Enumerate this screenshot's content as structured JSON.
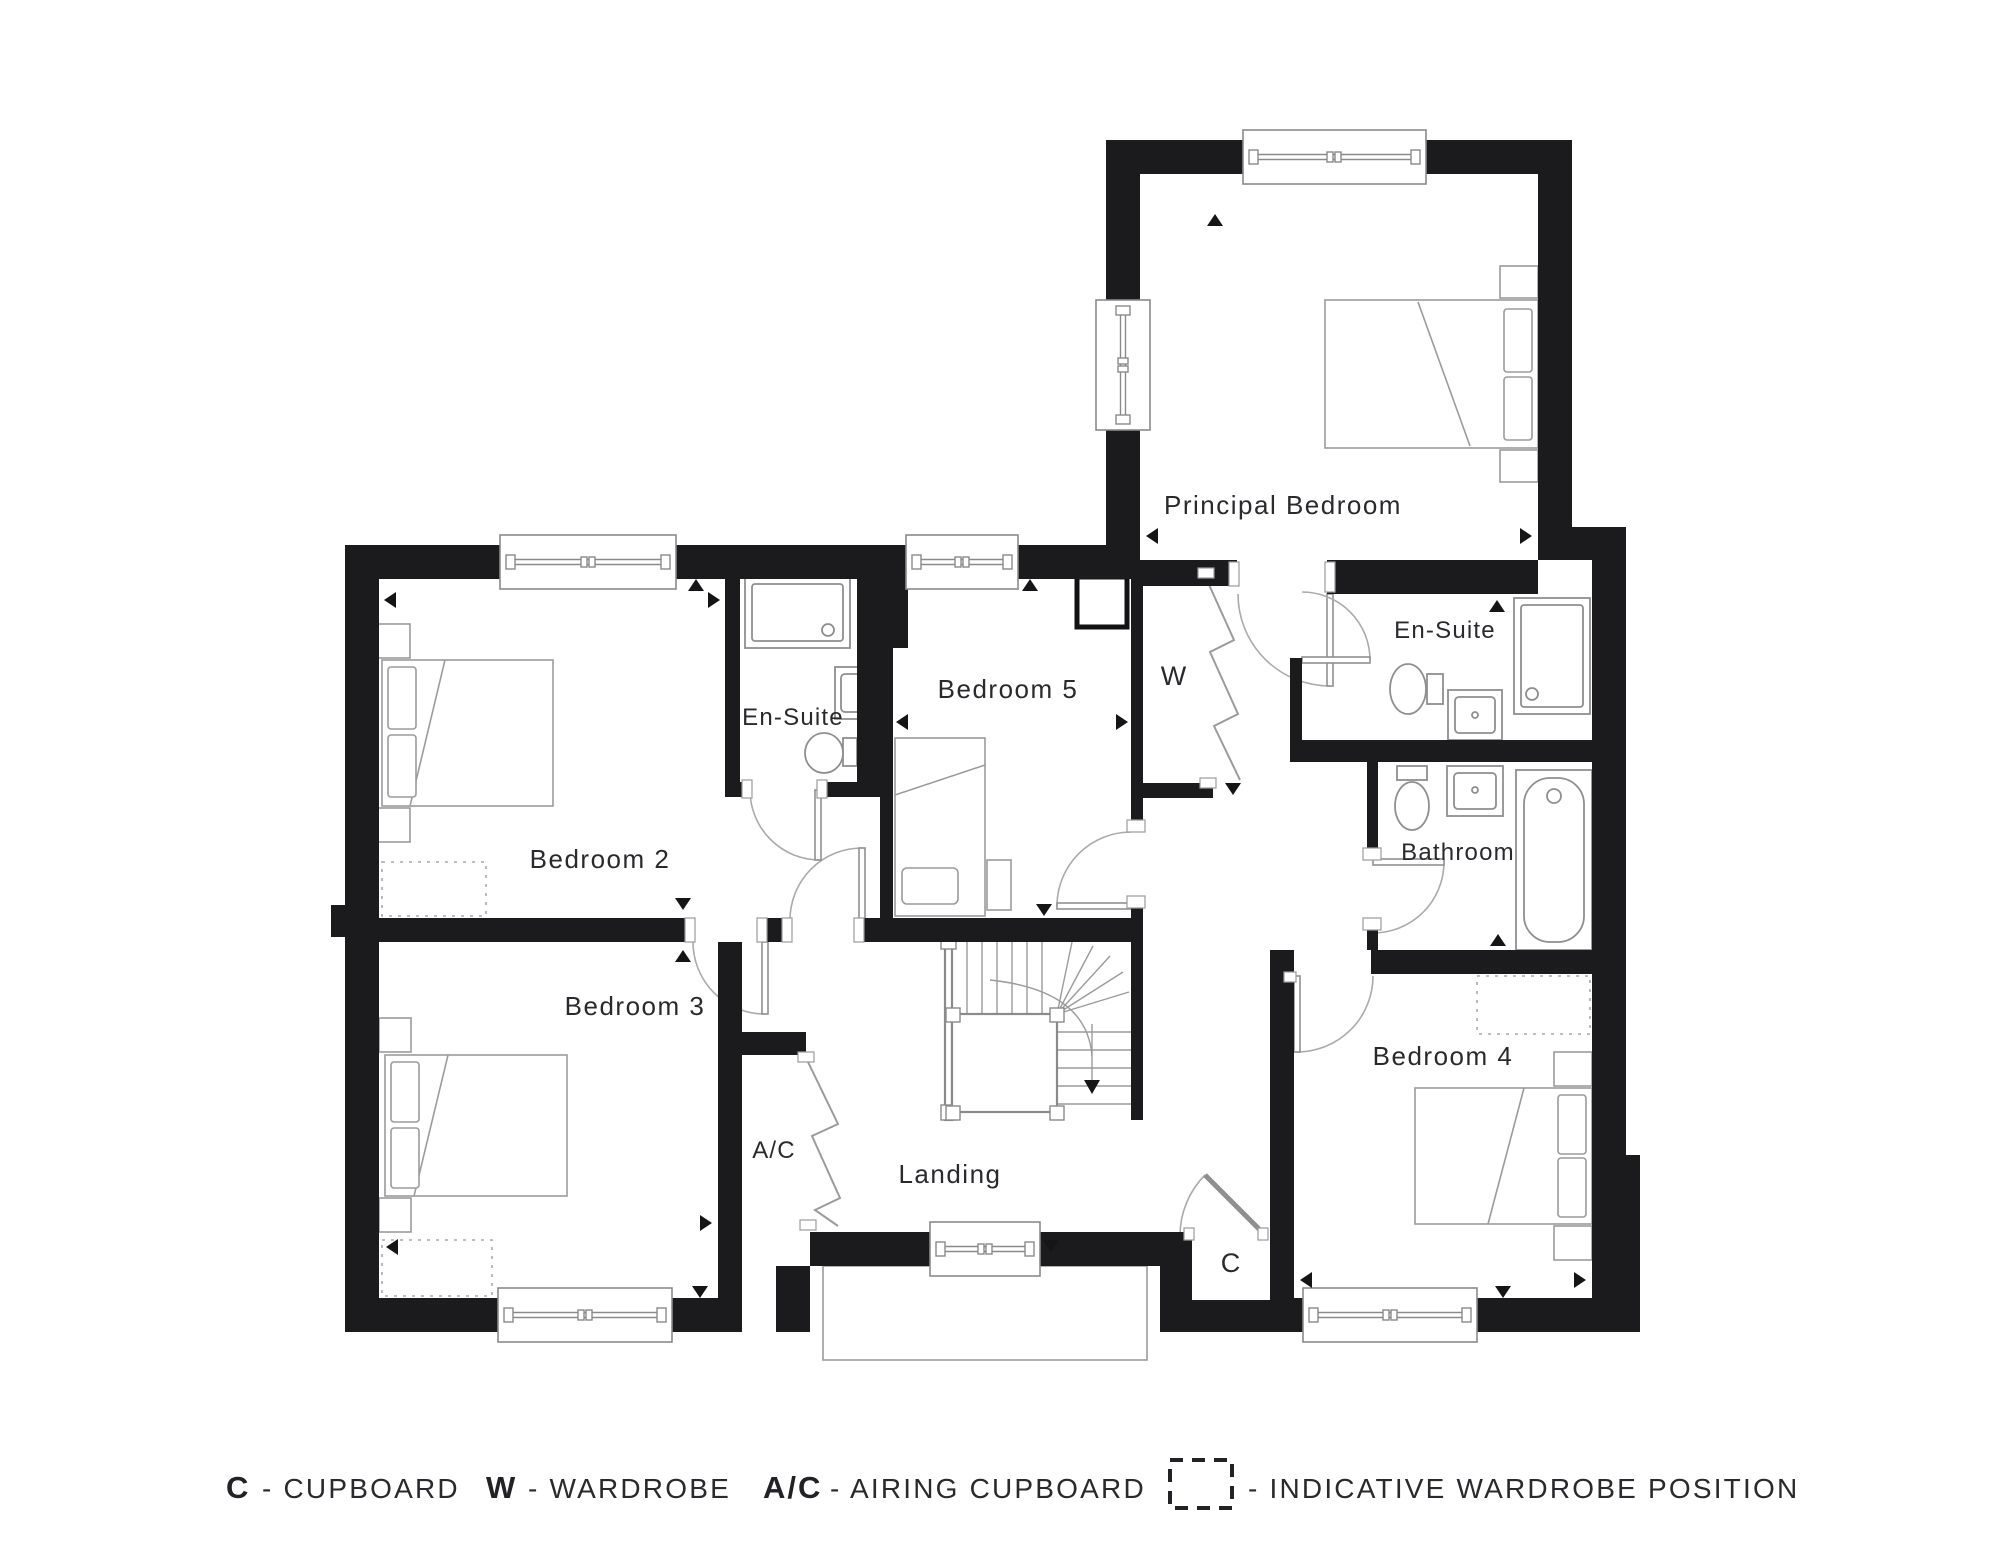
{
  "title": "First floor plan",
  "rooms": {
    "principal": "Principal Bedroom",
    "bedroom2": "Bedroom 2",
    "bedroom3": "Bedroom 3",
    "bedroom4": "Bedroom 4",
    "bedroom5": "Bedroom 5",
    "ensuite_principal": "En-Suite",
    "ensuite_bedroom2": "En-Suite",
    "bathroom": "Bathroom",
    "landing": "Landing",
    "wardrobe": "W",
    "cupboard": "C",
    "airing_cupboard": "A/C"
  },
  "legend": [
    {
      "symbol": "C",
      "label": "- CUPBOARD"
    },
    {
      "symbol": "W",
      "label": "- WARDROBE"
    },
    {
      "symbol": "A/C",
      "label": "- AIRING CUPBOARD"
    },
    {
      "symbol": "dashed-box-icon",
      "label": "- INDICATIVE WARDROBE POSITION"
    }
  ],
  "colors": {
    "wall": "#1b1b1e",
    "furniture_line": "#9b9b9b",
    "window_line": "#8a8a8a",
    "text": "#2a2a2e",
    "background": "#ffffff"
  }
}
